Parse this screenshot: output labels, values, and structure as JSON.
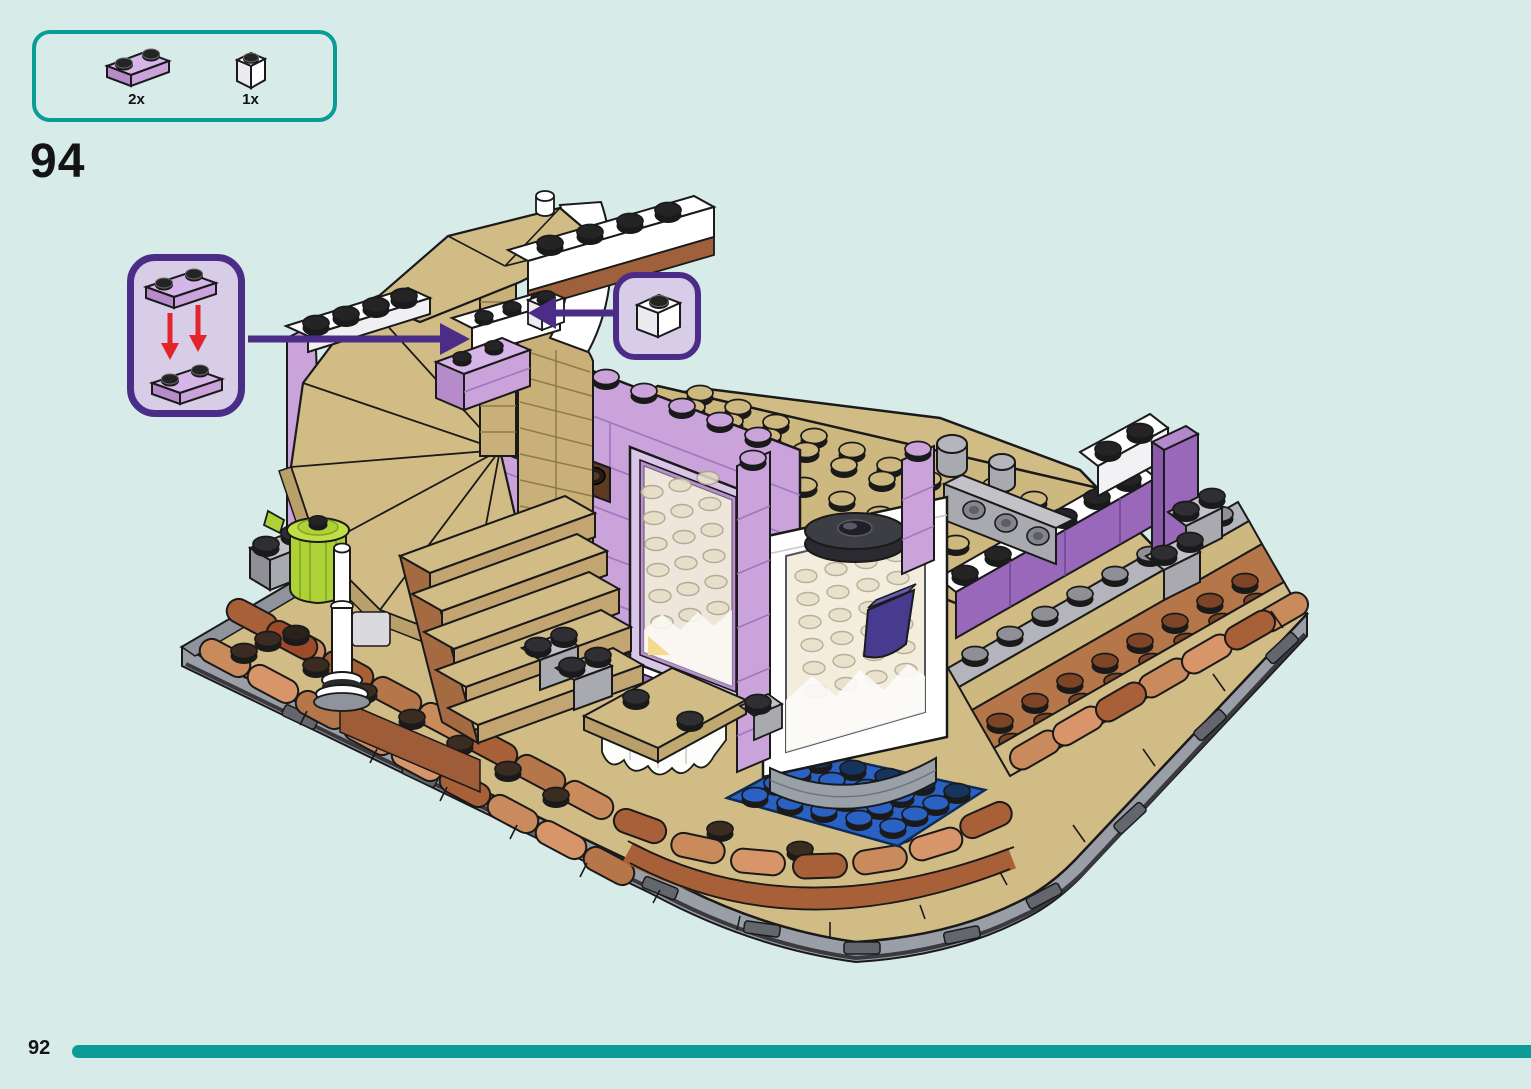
{
  "page": {
    "background_color": "#d7ebe9",
    "step_number": "94",
    "footer": {
      "page_number": "92",
      "progress_color": "#0b9c96",
      "progress_fraction": 0.95
    }
  },
  "parts_panel": {
    "border_color": "#0b9c96",
    "parts": [
      {
        "icon": "plate-1x2-lavender-icon",
        "label": "2x",
        "color": "#c9a3da"
      },
      {
        "icon": "brick-1x1-white-icon",
        "label": "1x",
        "color": "#ffffff"
      }
    ]
  },
  "callouts": {
    "border_color": "#4b2d87",
    "fill_color": "#d8cde7",
    "stack_plates": {
      "icon": "stack-two-1x2-lavender-plates-icon",
      "arrow_color": "#e3242b",
      "parts_count": 2
    },
    "place_brick": {
      "icon": "brick-1x1-white-icon",
      "parts_count": 1
    }
  },
  "illustration": {
    "name": "lego-friends-corner-building-isometric-view",
    "palette": {
      "lavender": "#c9a3da",
      "medium_lavender": "#a671c2",
      "dark_lavender": "#9a68bb",
      "tan": "#d2bc86",
      "dark_tan": "#b9a06a",
      "nougat": "#b5764a",
      "terracotta": "#a86038",
      "light_nougat": "#d8956a",
      "reddish_brown": "#7d4526",
      "blue": "#2a62c4",
      "dark_blue": "#16355e",
      "green": "#3ab54a",
      "lime": "#aed136",
      "white": "#ffffff",
      "light_gray": "#c2c2c8",
      "gray": "#a9a9b0",
      "dark_gray": "#6b6f76",
      "door_handle_purple": "#473a8f",
      "outline_black": "#1a1a1a"
    }
  }
}
